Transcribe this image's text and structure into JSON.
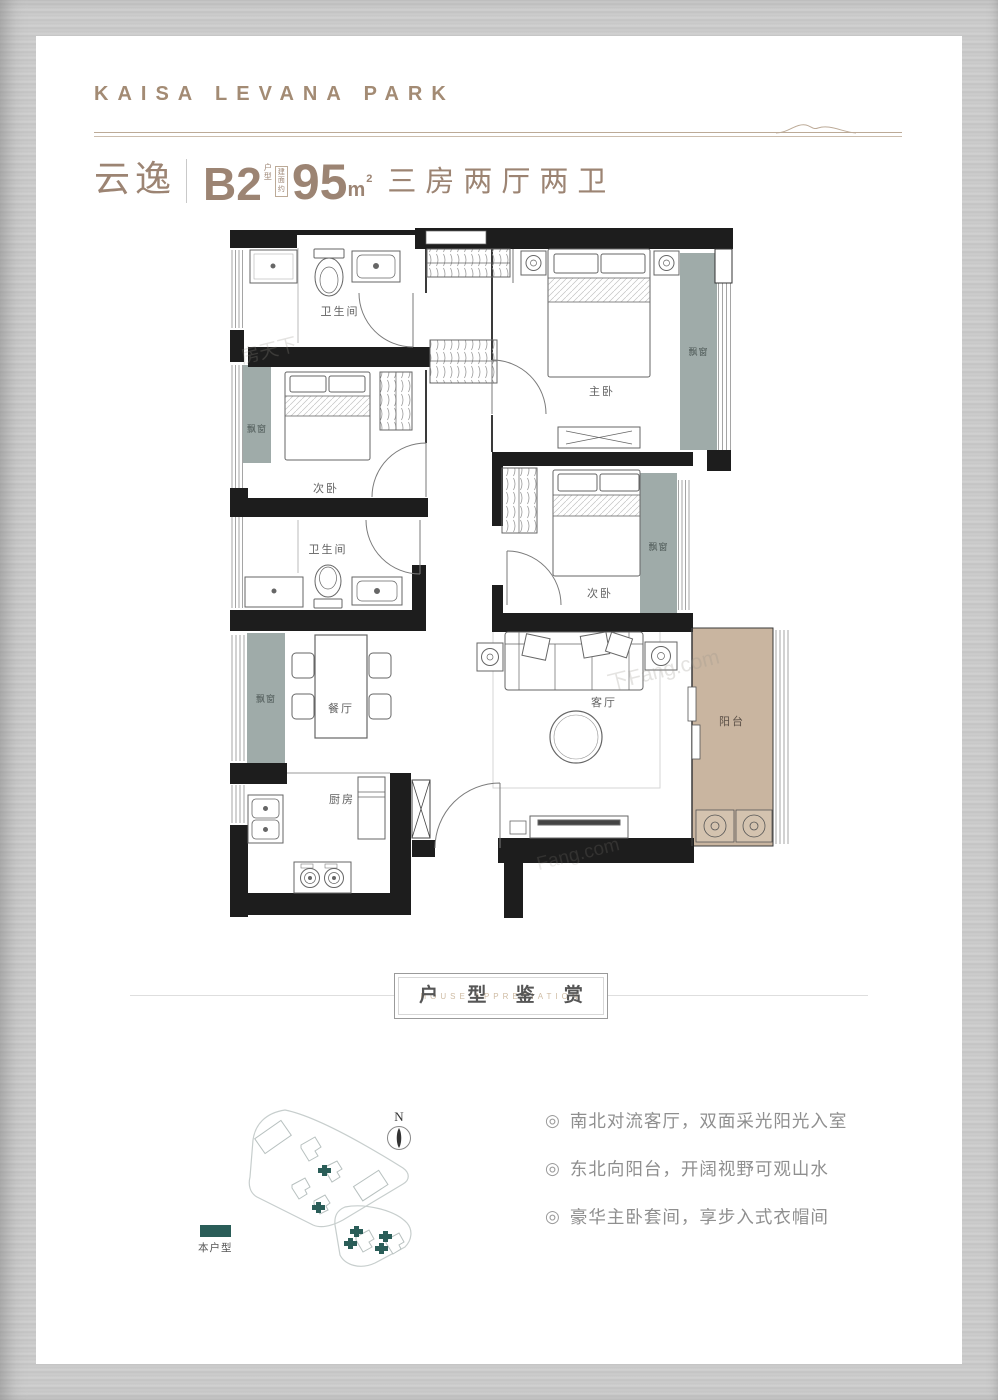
{
  "header": {
    "brand": "KAISA LEVANA PARK",
    "unit_name": "云逸",
    "unit_type": "B2",
    "unit_type_note": "户型",
    "area_note": "建面约",
    "area_value": "95",
    "area_unit": "m",
    "area_exp": "2",
    "layout_desc": "三房两厅两卫"
  },
  "plan": {
    "bath1": "卫生间",
    "bath2": "卫生间",
    "master": "主卧",
    "bed2": "次卧",
    "bed3": "次卧",
    "dining": "餐厅",
    "living": "客厅",
    "kitchen": "厨房",
    "balcony": "阳台",
    "bays": [
      "飘窗",
      "飘窗",
      "飘窗",
      "飘窗"
    ]
  },
  "banner": {
    "title": "户 型 鉴 赏",
    "subtitle": "HOUSE APPRECIATION"
  },
  "siteplan": {
    "north": "N",
    "legend": "本户型"
  },
  "features": {
    "bullet": "◎",
    "items": [
      "南北对流客厅，双面采光阳光入室",
      "东北向阳台，开阔视野可观山水",
      "豪华主卧套间，享步入式衣帽间"
    ]
  },
  "watermarks": {
    "w1": "房天下",
    "w2": "下Fang.com",
    "w3": "Fang.com"
  },
  "colors": {
    "brand_tan": "#9c8473",
    "wall": "#1d1d1d",
    "bay_window": "#9fabа9",
    "balcony": "#c9b5a0",
    "highlight_teal": "#2a5d58"
  }
}
